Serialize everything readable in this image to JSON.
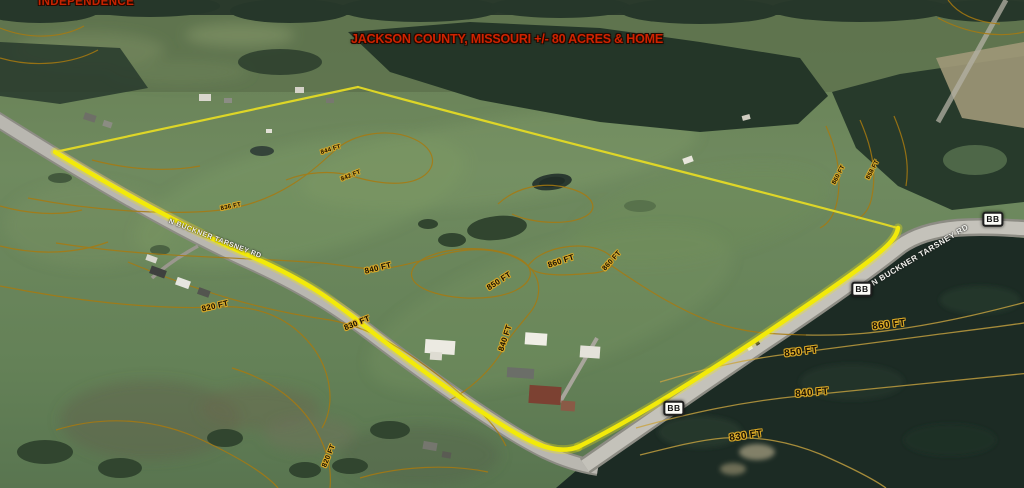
{
  "title": "JACKSON COUNTY, MISSOURI +/- 80 ACRES & HOME",
  "place_label": "INDEPENDENCE",
  "road_name": "N BUCKNER TARSNEY RD",
  "route_badge": "BB",
  "colors": {
    "title_red": "#d02300",
    "boundary_yellow": "#f2ea0a",
    "contour_orange": "#a87a10",
    "badge_text": "#101010"
  },
  "elevation_labels": [
    {
      "text": "840 FT"
    },
    {
      "text": "860 FT"
    },
    {
      "text": "850 FT"
    },
    {
      "text": "830 FT"
    },
    {
      "text": "820 FT"
    },
    {
      "text": "840 FT"
    },
    {
      "text": "860 FT"
    },
    {
      "text": "860 FT"
    },
    {
      "text": "850 FT"
    },
    {
      "text": "840 FT"
    },
    {
      "text": "830 FT"
    },
    {
      "text": "844 FT"
    },
    {
      "text": "842 FT"
    },
    {
      "text": "836 FT"
    },
    {
      "text": "860 FT"
    },
    {
      "text": "858 FT"
    },
    {
      "text": "820 FT"
    }
  ]
}
